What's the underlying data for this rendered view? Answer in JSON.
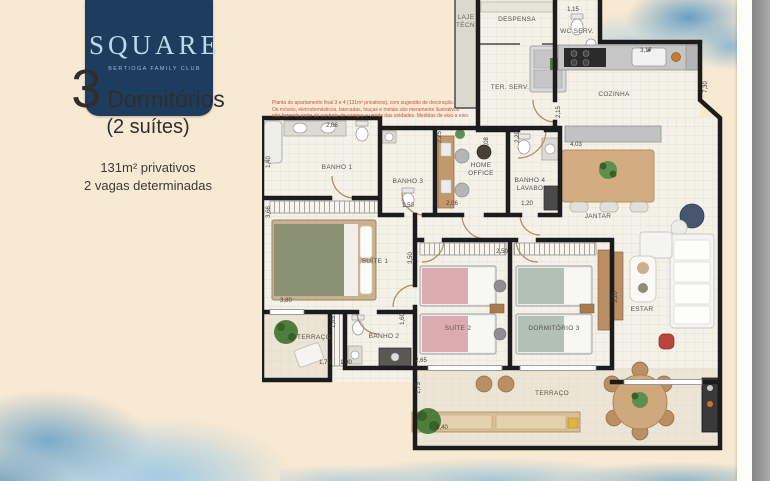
{
  "logo": {
    "brand": "SQUARE",
    "tagline": "BERTIOGA FAMILY CLUB"
  },
  "info": {
    "number": "3",
    "title": "Dormitórios",
    "subtitle": "(2 suítes)",
    "area": "131m² privativos",
    "parking": "2 vagas determinadas"
  },
  "disclaimer": {
    "line1": "Planta do apartamento final 3 e 4 (131m² privativos), com sugestão de decoração.",
    "line2": "Os móveis, eletrodomésticos, bancadas, louças e metais são meramente ilustrativos",
    "line3": "não fazendo parte do contrato de compra e venda das unidades. Medidas de eixo a eixo."
  },
  "rooms": [
    {
      "label": "BANHO 1"
    },
    {
      "label": "BANHO 3"
    },
    {
      "label": "HOME OFFICE"
    },
    {
      "label": "BANHO 4 LAVABO"
    },
    {
      "label": "SUÍTE 1"
    },
    {
      "label": "SUÍTE 2"
    },
    {
      "label": "DORMITÓRIO 3"
    },
    {
      "label": "BANHO 2"
    },
    {
      "label": "TERRAÇO"
    },
    {
      "label": "ESTAR"
    },
    {
      "label": "JANTAR"
    },
    {
      "label": "COZINHA"
    },
    {
      "label": "WC SERV."
    },
    {
      "label": "TER. SERV."
    },
    {
      "label": "DESPENSA"
    },
    {
      "label": "LAJE TÉCN."
    },
    {
      "label": "TERRAÇO"
    }
  ],
  "dims": [
    {
      "v": "2,06"
    },
    {
      "v": "1,40"
    },
    {
      "v": "3,66"
    },
    {
      "v": "3,80"
    },
    {
      "v": "2,25"
    },
    {
      "v": "2,29"
    },
    {
      "v": "2,06"
    },
    {
      "v": "1,50"
    },
    {
      "v": "1,20"
    },
    {
      "v": "1,15"
    },
    {
      "v": "3,17"
    },
    {
      "v": "7,30"
    },
    {
      "v": "4,03"
    },
    {
      "v": "4,08"
    },
    {
      "v": "2,15"
    },
    {
      "v": "3,50"
    },
    {
      "v": "2,50"
    },
    {
      "v": "1,60"
    },
    {
      "v": "1,65"
    },
    {
      "v": "1,70"
    },
    {
      "v": "1,90"
    },
    {
      "v": "2,65"
    },
    {
      "v": "1,75"
    },
    {
      "v": "8,40"
    },
    {
      "v": "3,20"
    }
  ],
  "colors": {
    "page_bg": "#f8e9d2",
    "logo_navy": "#1d3c5e",
    "watercolor_blue": "#6ca4c7",
    "wall": "#1c1c1c",
    "wood": "#c9a57b",
    "bed_suite1": "#8b9173",
    "bed_suite2": "#dbabb0",
    "bed_dorm3": "#b2c1b2"
  }
}
